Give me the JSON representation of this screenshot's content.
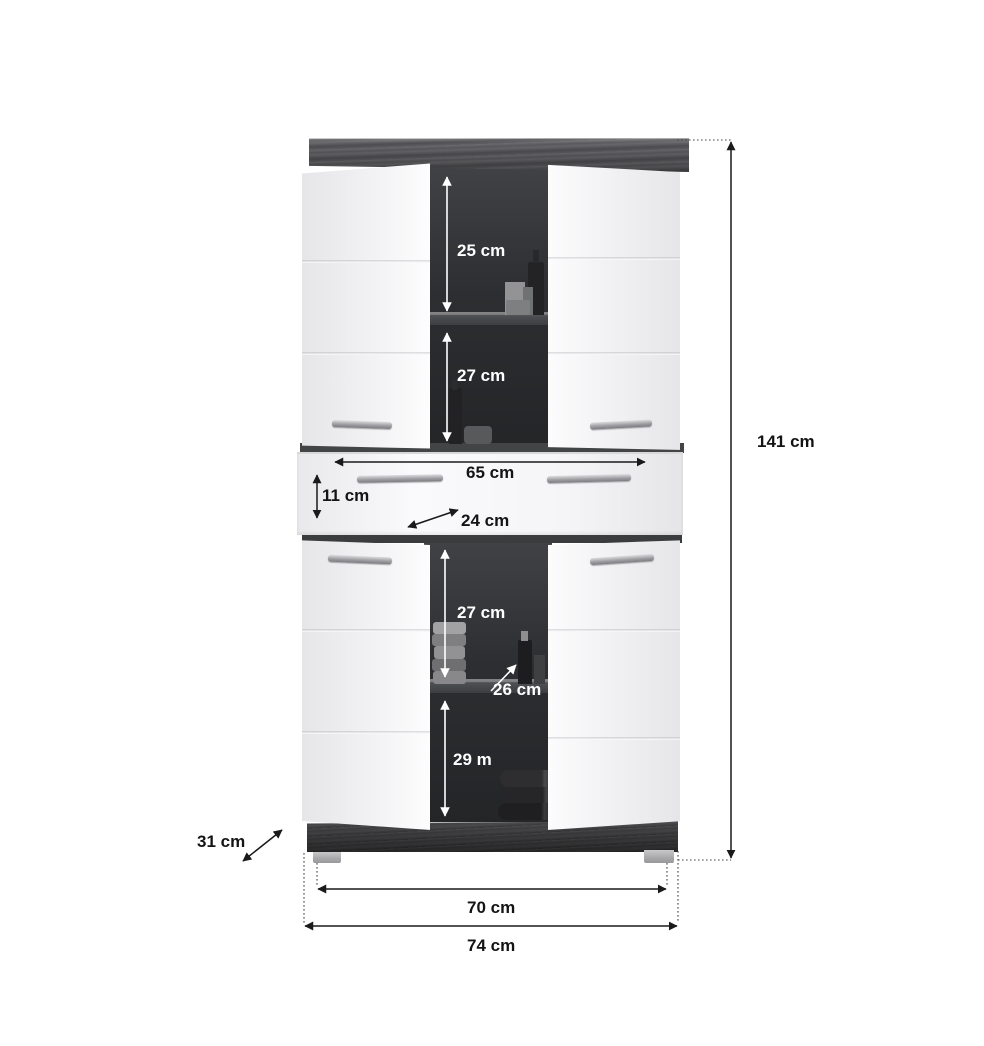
{
  "diagram": {
    "kind": "furniture dimension drawing",
    "subject": "tall bathroom cabinet with 4 doors and 1 drawer, open doors showing shelves"
  },
  "dims": {
    "top_compartment": "25 cm",
    "upper_second_compartment": "27 cm",
    "drawer_width": "65 cm",
    "drawer_height": "11 cm",
    "drawer_depth": "24 cm",
    "lower_first_compartment": "27 cm",
    "lower_shelf_depth": "26 cm",
    "lower_second_compartment": "29 m",
    "overall_height": "141 cm",
    "overall_depth": "31 cm",
    "feet_span": "70 cm",
    "overall_width": "74 cm"
  },
  "colors": {
    "background": "#ffffff",
    "door_white": "#f2f2f4",
    "wood_dark": "#5a5a5e",
    "interior_dark": "#2c2e31",
    "handle_silver": "#a0a0a4",
    "dimension_line_dark": "#1a1a1a",
    "dimension_line_light": "#ffffff"
  }
}
